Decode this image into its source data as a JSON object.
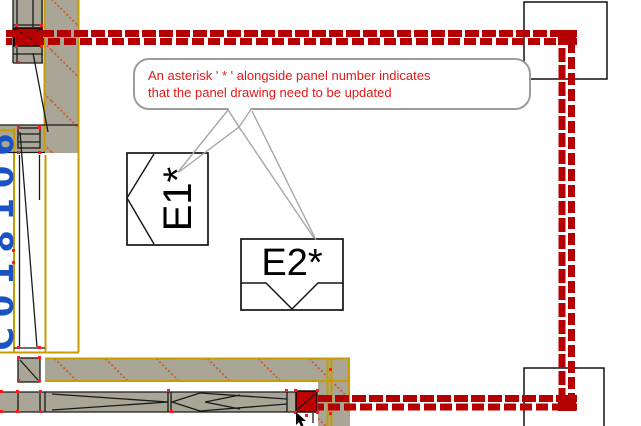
{
  "drawing": {
    "callout": {
      "line1": "An asterisk ' * ' alongside panel number indicates",
      "line2": "that the panel drawing need to be updated"
    },
    "panels": {
      "panel1": "E1*",
      "panel2": "E2*"
    },
    "left_label": "C018106",
    "colors": {
      "red_band": "#B40000",
      "red_fill": "#C00000",
      "callout_text": "#E01818",
      "wall_tan": "#A9A597",
      "olive_line": "#C69C00",
      "hatch_orange": "#C8551D",
      "blue_label": "#1B52C3",
      "leader_gray": "#A6A6A6"
    }
  }
}
